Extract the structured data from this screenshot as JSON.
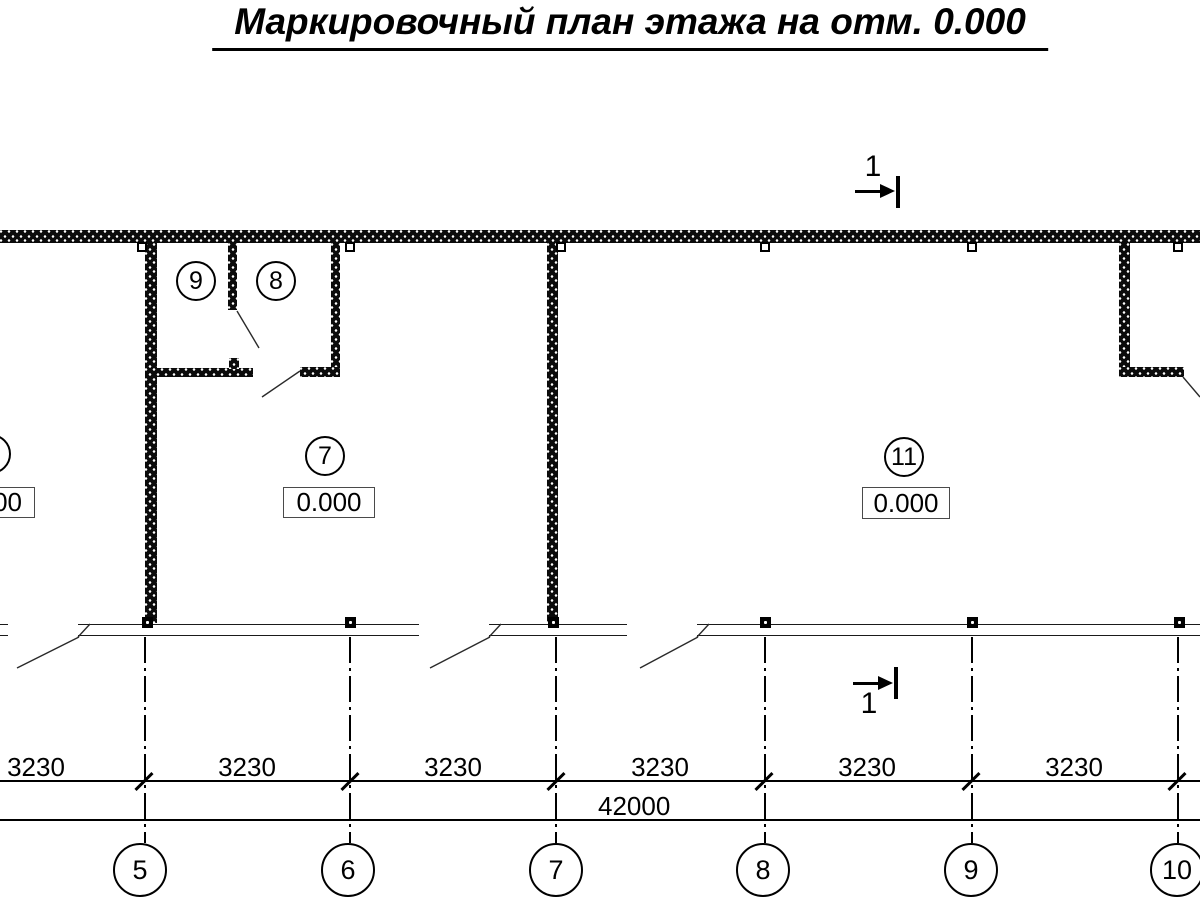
{
  "title": "Маркировочный план этажа на отм. 0.000",
  "section_marks": {
    "top_label": "1",
    "bottom_label": "1"
  },
  "rooms": {
    "r9": {
      "number": "9"
    },
    "r8": {
      "number": "8"
    },
    "r7": {
      "number": "7",
      "elevation": "0.000"
    },
    "r11": {
      "number": "11",
      "elevation": "0.000"
    },
    "left_partial": {
      "elevation": "0.000"
    }
  },
  "dimensions": {
    "segments": [
      "3230",
      "3230",
      "3230",
      "3230",
      "3230",
      "3230"
    ],
    "total": "42000"
  },
  "grid_axes": [
    "5",
    "6",
    "7",
    "8",
    "9",
    "10"
  ]
}
